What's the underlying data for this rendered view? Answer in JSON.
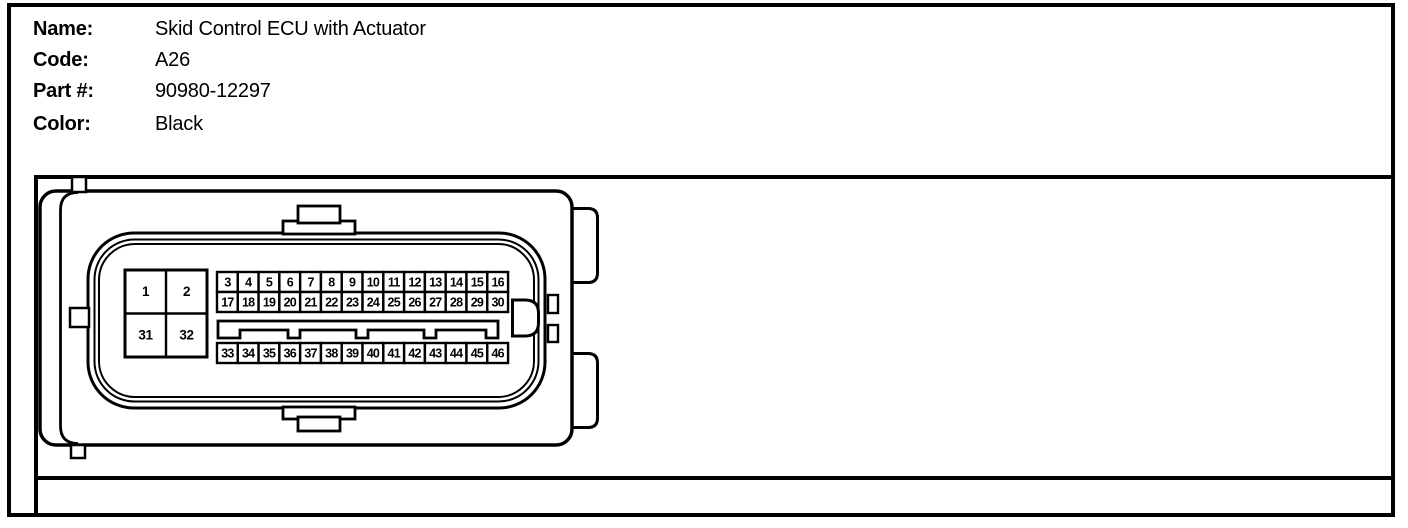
{
  "colors": {
    "line": "#000000",
    "background": "#ffffff"
  },
  "header": {
    "rows": [
      {
        "label": "Name:",
        "value": "Skid Control ECU with Actuator"
      },
      {
        "label": "Code:",
        "value": "A26"
      },
      {
        "label": "Part #:",
        "value": "90980-12297"
      },
      {
        "label": "Color:",
        "value": "Black"
      }
    ]
  },
  "connector": {
    "corner_pins": [
      "1",
      "2",
      "31",
      "32"
    ],
    "pin_rows": [
      {
        "name": "row-top",
        "pins": [
          "3",
          "4",
          "5",
          "6",
          "7",
          "8",
          "9",
          "10",
          "11",
          "12",
          "13",
          "14",
          "15",
          "16"
        ]
      },
      {
        "name": "row-middle",
        "pins": [
          "17",
          "18",
          "19",
          "20",
          "21",
          "22",
          "23",
          "24",
          "25",
          "26",
          "27",
          "28",
          "29",
          "30"
        ]
      },
      {
        "name": "row-bottom",
        "pins": [
          "33",
          "34",
          "35",
          "36",
          "37",
          "38",
          "39",
          "40",
          "41",
          "42",
          "43",
          "44",
          "45",
          "46"
        ]
      }
    ]
  }
}
